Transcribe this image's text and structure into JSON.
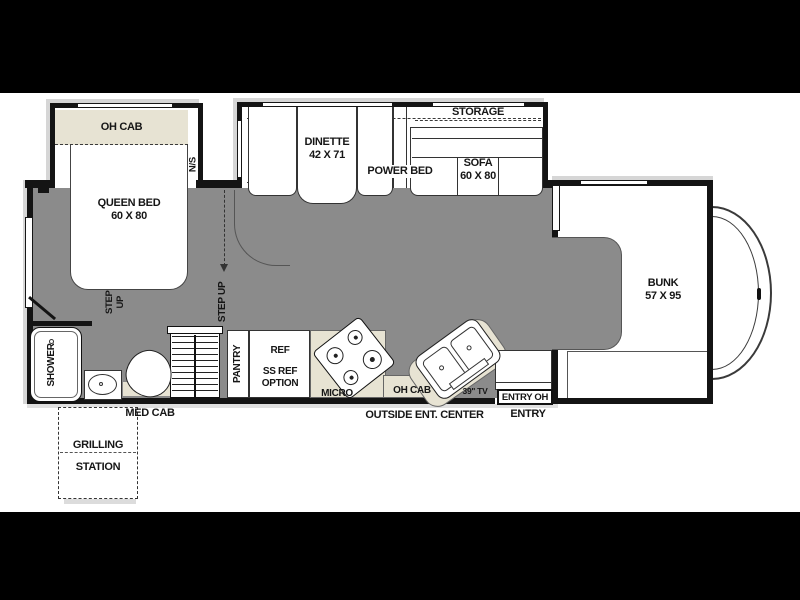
{
  "diagram_type": "RV motorhome floorplan",
  "colors": {
    "frame": "#000000",
    "canvas": "#ffffff",
    "floor": "#8b8b8b",
    "cabinet": "#e7e3d3",
    "wall": "#141414",
    "shadow": "#d6d6d6"
  },
  "labels": {
    "bedroom": {
      "oh_cab": "OH CAB",
      "ns": "N/S",
      "queen_l1": "QUEEN BED",
      "queen_l2": "60 X 80",
      "step_l1": "STEP",
      "step_l2": "UP"
    },
    "slideout": {
      "dinette_l1": "DINETTE",
      "dinette_l2": "42 X 71",
      "power_bed": "POWER BED",
      "storage": "STORAGE",
      "sofa_l1": "SOFA",
      "sofa_l2": "60 X 80"
    },
    "aisle": {
      "step_up": "STEP UP"
    },
    "bunk": {
      "l1": "BUNK",
      "l2": "57 X 95"
    },
    "bath": {
      "shower": "SHOWER",
      "med_cab": "MED CAB"
    },
    "kitchen": {
      "pantry": "PANTRY",
      "ref_l1": "REF",
      "ref_l2": "SS REF",
      "ref_l3": "OPTION",
      "micro": "MICRO",
      "oh_cab": "OH CAB",
      "tv": "39\" TV"
    },
    "entry": {
      "entry_oh": "ENTRY OH",
      "entry": "ENTRY"
    },
    "exterior": {
      "outside_ent": "OUTSIDE ENT. CENTER",
      "grilling_l1": "GRILLING",
      "grilling_l2": "STATION"
    }
  }
}
